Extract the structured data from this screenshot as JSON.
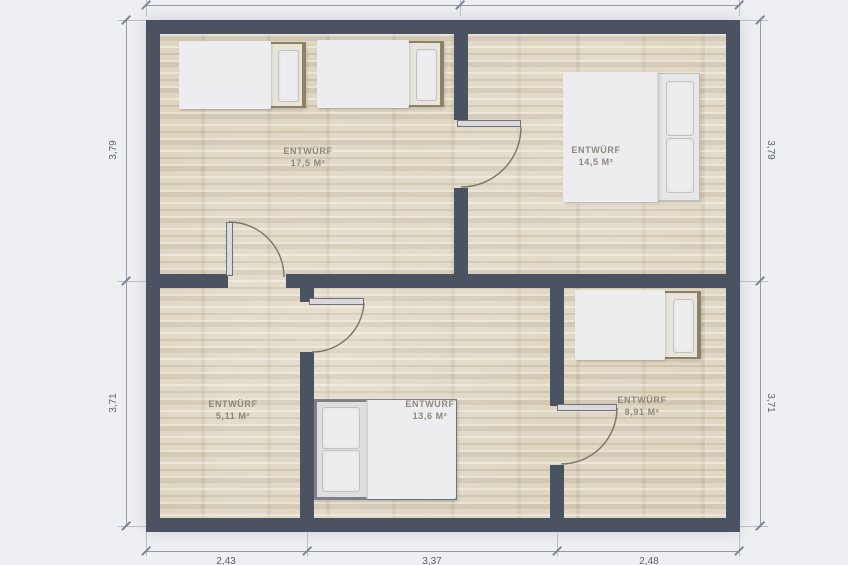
{
  "plan": {
    "rooms": [
      {
        "name": "ENTWÜRF",
        "area": "17,5 M²"
      },
      {
        "name": "ENTWÜRF",
        "area": "14,5 M²"
      },
      {
        "name": "ENTWÜRF",
        "area": "5,11 M²"
      },
      {
        "name": "ENTWÜRF",
        "area": "13,6 M²"
      },
      {
        "name": "ENTWÜRF",
        "area": "8,91 M²"
      }
    ],
    "dimensions": {
      "left_top": "3,79",
      "left_bottom": "3,71",
      "right_top": "3,79",
      "right_bottom": "3,71",
      "bottom_left": "2,43",
      "bottom_middle": "3,37",
      "bottom_right": "2,48"
    },
    "colors": {
      "wall": "#4b5362",
      "floor_base": "#ddd4bf",
      "dimension_line": "#939aab",
      "dimension_text": "#5c636e",
      "room_label": "#8c887c"
    }
  }
}
